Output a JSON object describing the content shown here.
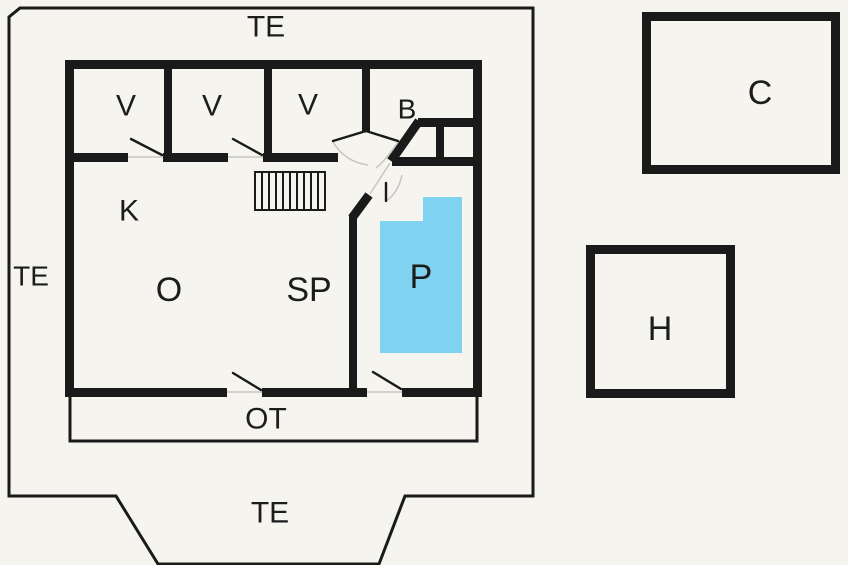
{
  "colors": {
    "background": "#f6f4ef",
    "wall": "#1a1a1a",
    "pool_fill": "#7fd2f0",
    "label_text": "#1c1c1c",
    "door_swing": "#c9c7c0"
  },
  "labels": {
    "terrace_top": "TE",
    "terrace_left": "TE",
    "terrace_bottom": "TE",
    "porch": "OT",
    "room_v1": "V",
    "room_v2": "V",
    "room_v3": "V",
    "room_b": "B",
    "room_k": "K",
    "room_o": "O",
    "room_sp": "SP",
    "room_p": "P",
    "building_c": "C",
    "building_h": "H"
  }
}
